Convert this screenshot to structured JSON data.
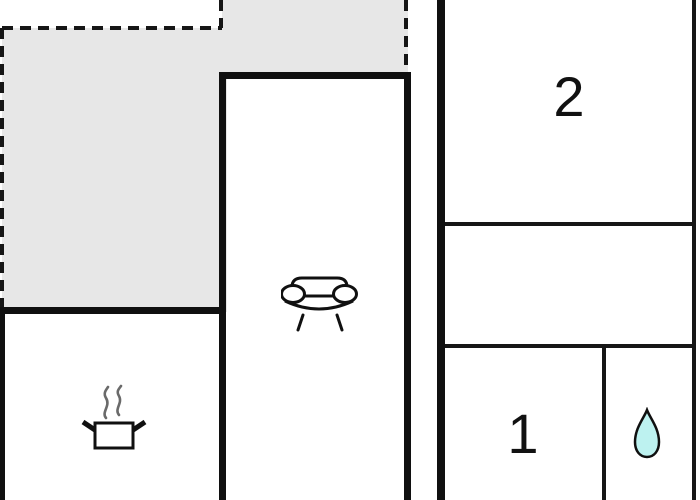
{
  "floorplan": {
    "room_labels": {
      "room_2": "2",
      "room_1": "1"
    },
    "icons": {
      "living_room": "sofa-icon",
      "kitchen": "cooking-pot-icon",
      "bathroom": "water-drop-icon"
    },
    "colors": {
      "background": "#ffffff",
      "wall": "#101010",
      "terrace_fill": "#e7e7e7",
      "water_drop_fill": "#bdf2f0",
      "steam": "#6a6a6a"
    }
  }
}
